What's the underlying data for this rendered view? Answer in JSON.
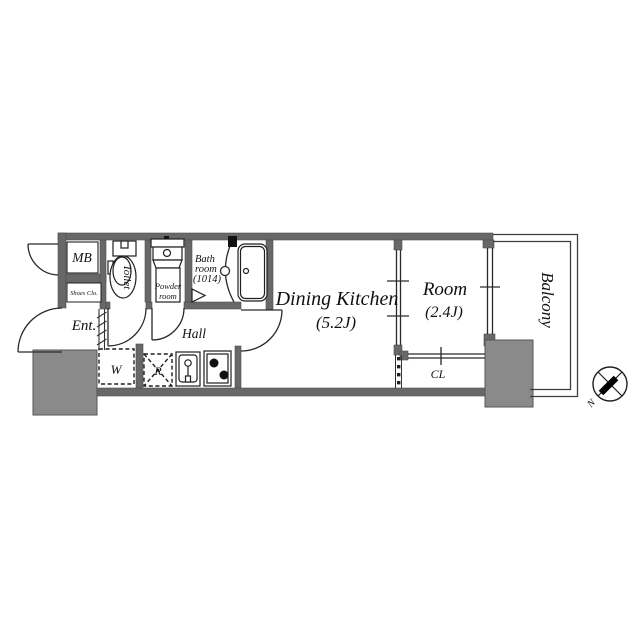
{
  "colors": {
    "background": "#ffffff",
    "wall": "#686868",
    "pillar": "#8a8a8a",
    "line": "#1f1f1f"
  },
  "rooms": {
    "dining_kitchen": {
      "name": "Dining Kitchen",
      "size": "(5.2J)"
    },
    "room": {
      "name": "Room",
      "size": "(2.4J)"
    },
    "balcony": {
      "name": "Balcony"
    },
    "hall": {
      "name": "Hall"
    },
    "entrance": {
      "name": "Ent."
    },
    "toilet": {
      "name": "Toilet"
    },
    "powder_room": {
      "line1": "Powder",
      "line2": "room"
    },
    "bath_room": {
      "line1": "Bath",
      "line2": "room",
      "line3": "(1014)"
    },
    "meter_box": {
      "name": "MB"
    },
    "shoes_closet": {
      "name": "Shoes Clo."
    },
    "closet": {
      "name": "CL"
    }
  },
  "appliances": {
    "washer": "W",
    "refrigerator": "R"
  },
  "compass": {
    "north": "N"
  }
}
